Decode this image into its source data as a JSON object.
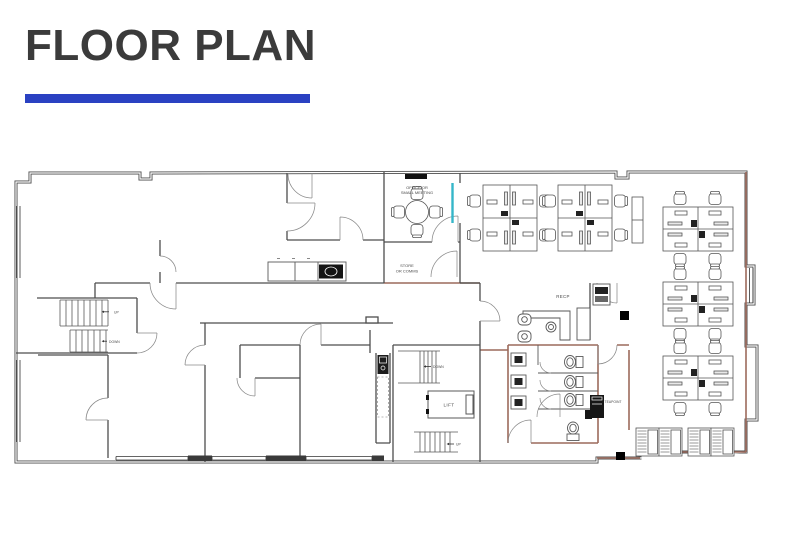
{
  "page": {
    "title": "FLOOR PLAN"
  },
  "colors": {
    "title_text": "#3b3b3b",
    "accent_bar": "#2a41c2",
    "walls": "#4d4d4d",
    "fitout_walls": "#9c6a5c",
    "glazing_partition": "#35b6c9",
    "drawing_background": "#ffffff"
  },
  "plan": {
    "labels": {
      "office_meeting_line1": "OFFICE OR",
      "office_meeting_line2": "SMALL MEETING",
      "store_line1": "STORE",
      "store_line2": "OR COMMS",
      "reception": "RECP",
      "lift": "LIFT",
      "teapoint": "TEAPOINT",
      "stair_left_up": "UP",
      "stair_left_down": "DOWN",
      "stair_core_down": "DOWN",
      "stair_core_up": "UP"
    }
  }
}
